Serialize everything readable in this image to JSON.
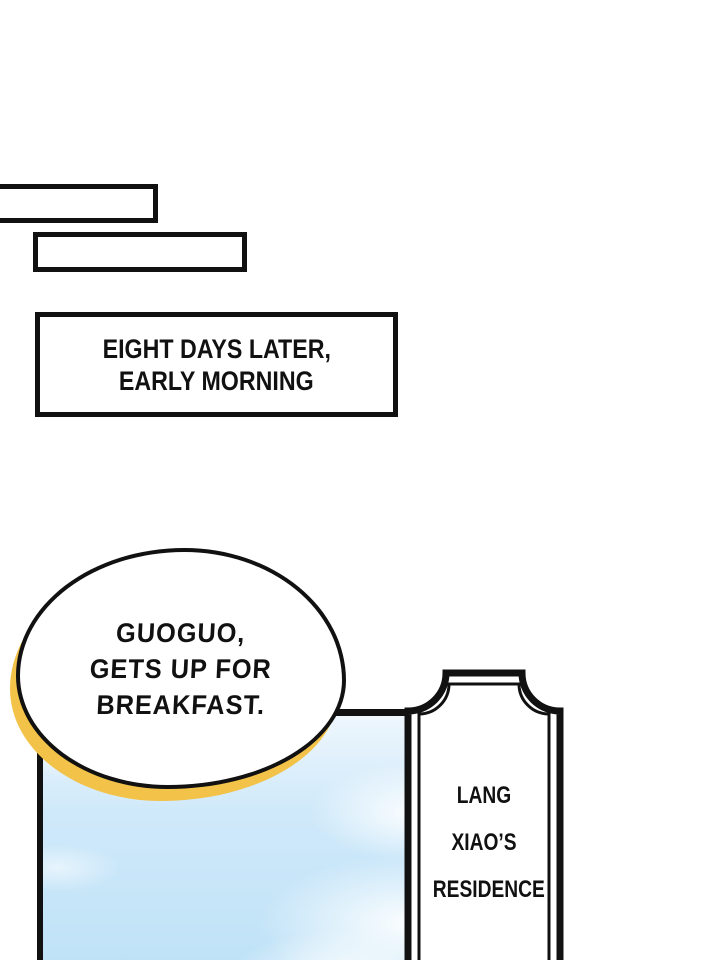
{
  "colors": {
    "ink": "#111111",
    "paper": "#ffffff",
    "accent-yellow": "#f2c249",
    "sky-top": "#eef6fd",
    "sky-mid": "#cfe9fa",
    "sky-bottom": "#bfe2f7"
  },
  "caption_box": {
    "lines": [
      "EIGHT DAYS LATER,",
      "EARLY MORNING"
    ]
  },
  "speech_bubble": {
    "lines": [
      "GUOGUO,",
      "GETS UP FOR",
      "BREAKFAST."
    ]
  },
  "sign": {
    "lines": [
      "LANG",
      "XIAO’S",
      "RESIDENCE"
    ]
  }
}
